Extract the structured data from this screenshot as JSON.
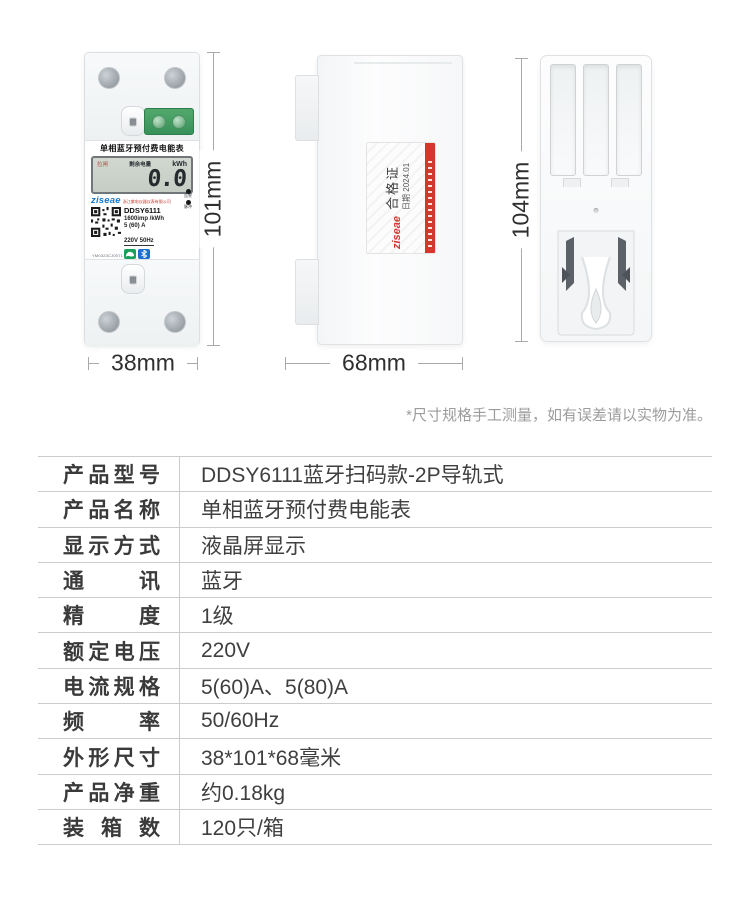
{
  "note": "*尺寸规格手工测量，如有误差请以实物为准。",
  "dimensions": {
    "front_height": "101mm",
    "front_width": "38mm",
    "side_depth": "68mm",
    "back_height": "104mm"
  },
  "meter_front": {
    "title": "单相蓝牙预付费电能表",
    "lcd_status": "拉闸",
    "lcd_label": "剩余电量",
    "lcd_unit": "kWh",
    "lcd_value": "0.0",
    "brand": "ziseae",
    "company": "浙江紫电仪器仪表有限公司",
    "model": "DDSY6111",
    "meter_constant": "1600imp /kWh",
    "current_spec": "5 (60) A",
    "voltage_freq": "220V 50Hz",
    "indicator_alarm": "告警",
    "indicator_pulse": "脉冲",
    "serial": "YM0323CJ0071"
  },
  "side_label": {
    "brand": "ziseae",
    "cert_title": "合格证",
    "cert_date": "日期 2024.01"
  },
  "spec_table": {
    "rows": [
      {
        "label": "产品型号",
        "value": "DDSY6111蓝牙扫码款-2P导轨式"
      },
      {
        "label": "产品名称",
        "value": "单相蓝牙预付费电能表"
      },
      {
        "label": "显示方式",
        "value": "液晶屏显示"
      },
      {
        "label": "通讯",
        "value": "蓝牙"
      },
      {
        "label": "精度",
        "value": "1级"
      },
      {
        "label": "额定电压",
        "value": "220V"
      },
      {
        "label": "电流规格",
        "value": "5(60)A、5(80)A"
      },
      {
        "label": "频率",
        "value": "50/60Hz"
      },
      {
        "label": "外形尺寸",
        "value": "38*101*68毫米"
      },
      {
        "label": "产品净重",
        "value": "约0.18kg"
      },
      {
        "label": "装箱数",
        "value": "120只/箱"
      }
    ]
  },
  "colors": {
    "brand_blue": "#1579cd",
    "brand_red": "#d03a2f",
    "terminal_green": "#37915a",
    "lcd_background": "#ccd2c9",
    "table_line": "#cccccc",
    "note_gray": "#9c9c9c"
  }
}
